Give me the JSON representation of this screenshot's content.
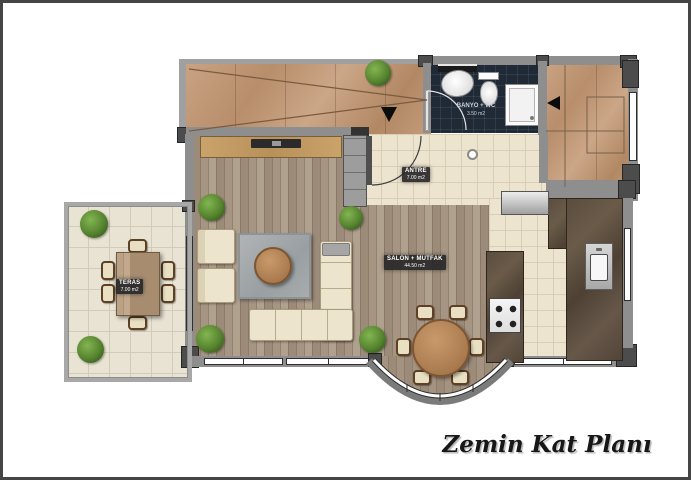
{
  "title": {
    "text": "Zemin Kat Planı"
  },
  "rooms": {
    "banyo": {
      "label": "BANYO + WC",
      "area": "3.50 m2"
    },
    "antre": {
      "label": "ANTRE",
      "area": "7.00 m2"
    },
    "salon": {
      "label": "SALON + MUTFAK",
      "area": "44.50 m2"
    },
    "teras": {
      "label": "TERAS",
      "area": "7.00 m2"
    }
  },
  "symbols": {
    "entry_arrow": "down-arrow-entry",
    "stair_arrow": "left-arrow-stairs",
    "furniture": [
      "tv-unit",
      "wardrobe",
      "armchair",
      "l-shaped-sofa",
      "rug",
      "coffee-table",
      "round-dining-table",
      "dining-chair",
      "terrace-table",
      "terrace-chair",
      "plant",
      "refrigerator",
      "cooktop",
      "kitchen-island",
      "kitchen-counter",
      "kitchen-sink",
      "washbasin",
      "toilet",
      "shower",
      "stairs",
      "door-swing"
    ]
  },
  "colors": {
    "frame": "#454545",
    "wall": "#8e8e8e",
    "wall_dark": "#4c4c4c",
    "wood_floor": "#9a8878",
    "marble": "#c2997a",
    "tile": "#ede4d0",
    "bath_tile": "#202a36",
    "granite": "#544639",
    "upholstery": "#ece4cd",
    "plant_green": "#56842f",
    "label_badge": "#282828",
    "title_text": "#171717"
  }
}
